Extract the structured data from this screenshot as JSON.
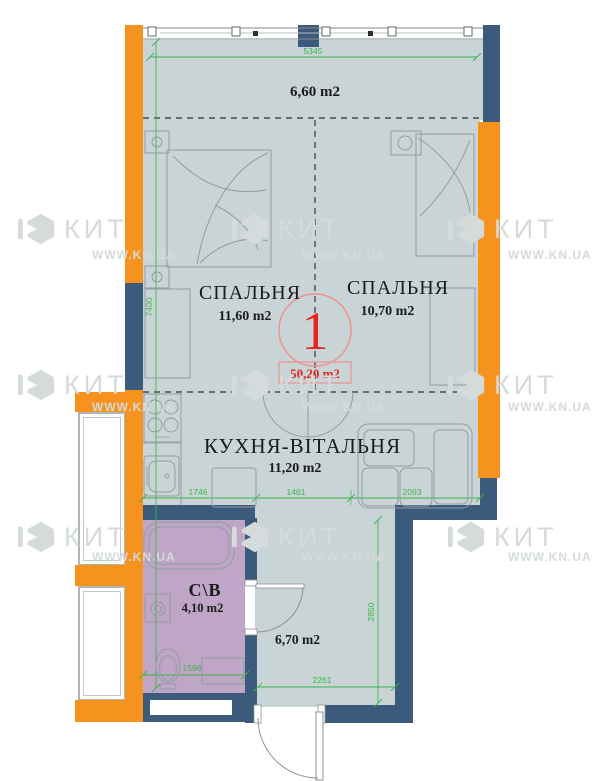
{
  "watermark": {
    "brand": "КИТ",
    "site": "WWW.KN.UA"
  },
  "unit": {
    "number": "1",
    "total_area": "50,20 m2"
  },
  "rooms": {
    "balcony": {
      "area": "6,60 m2"
    },
    "bedroom1": {
      "name": "СПАЛЬНЯ",
      "area": "11,60 m2"
    },
    "bedroom2": {
      "name": "СПАЛЬНЯ",
      "area": "10,70 m2"
    },
    "kitchen": {
      "name": "КУХНЯ-ВІТАЛЬНЯ",
      "area": "11,20 m2"
    },
    "bathroom": {
      "name": "С\\В",
      "area": "4,10 m2"
    },
    "hallway": {
      "area": "6,70 m2"
    }
  },
  "dimensions": {
    "top_width": "5345",
    "left_height": "7400",
    "kitchen_left": "1746",
    "kitchen_mid": "1461",
    "kitchen_right": "2093",
    "bathroom_width": "1596",
    "hallway_width": "2261",
    "hallway_height": "2850"
  },
  "colors": {
    "floor": "#c9d4d6",
    "bathroom_floor": "#bfa5c6",
    "wall_accent": "#f6921e",
    "wall_main": "#3c5a7c",
    "dimension_green": "#3cb44a",
    "marker_red": "#e52620"
  }
}
